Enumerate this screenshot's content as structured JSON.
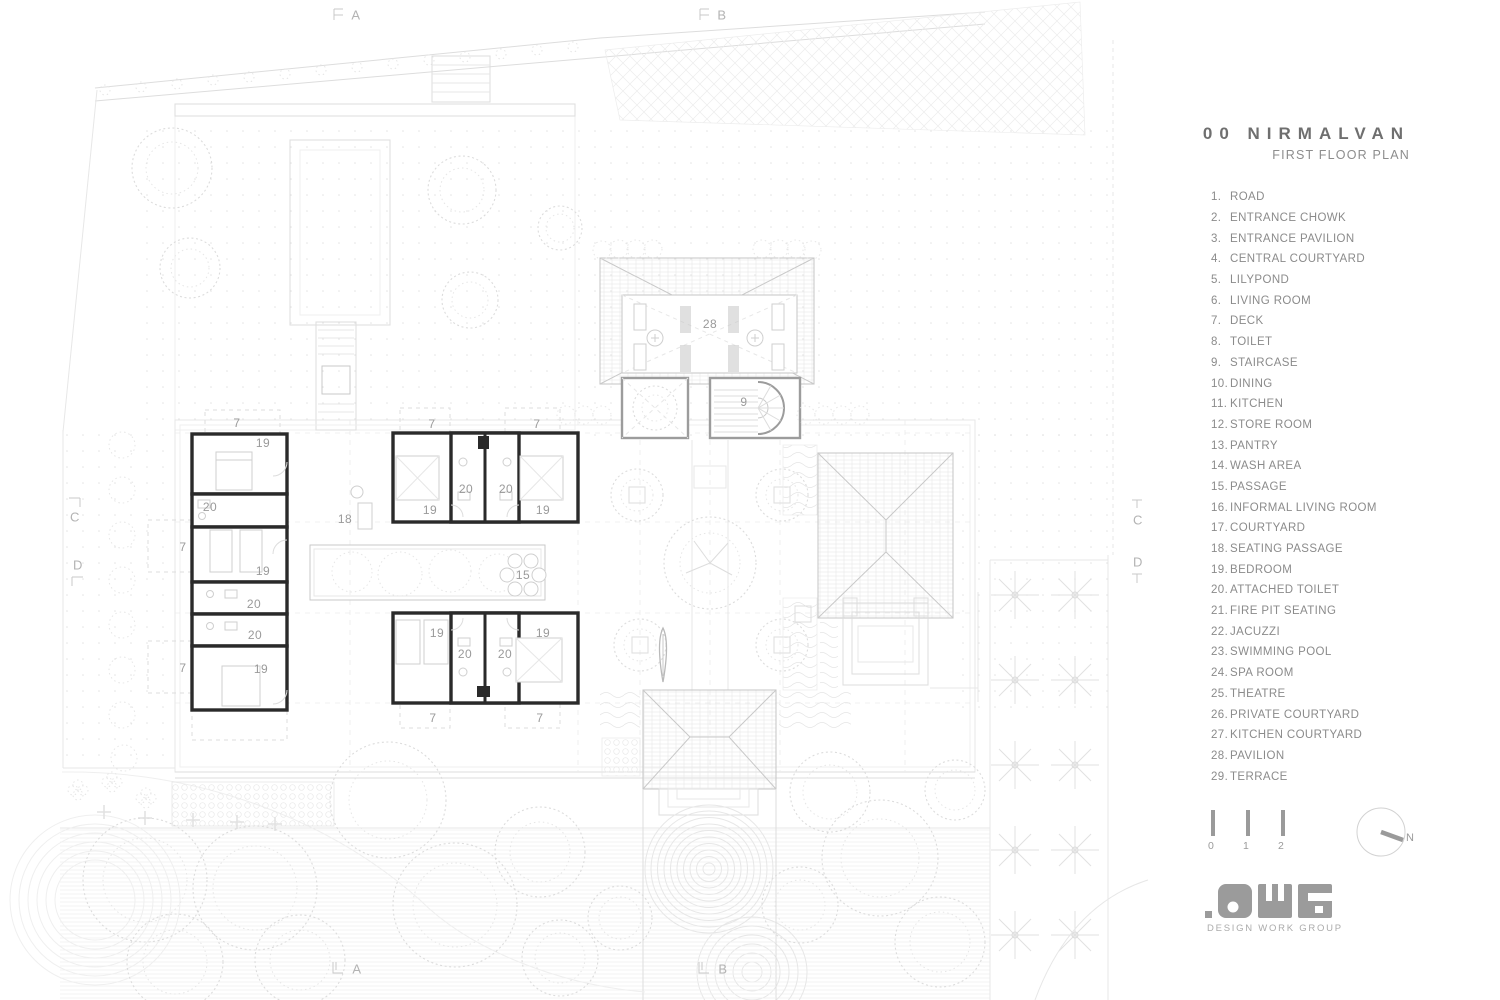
{
  "panel": {
    "title": "00 NIRMALVAN",
    "subtitle": "FIRST FLOOR PLAN",
    "north_label": "N",
    "logo_alt": ".DWG",
    "logo_caption": "DESIGN WORK GROUP"
  },
  "legend": {
    "items": [
      {
        "n": "1.",
        "t": "ROAD"
      },
      {
        "n": "2.",
        "t": "ENTRANCE CHOWK"
      },
      {
        "n": "3.",
        "t": "ENTRANCE PAVILION"
      },
      {
        "n": "4.",
        "t": "CENTRAL COURTYARD"
      },
      {
        "n": "5.",
        "t": "LILYPOND"
      },
      {
        "n": "6.",
        "t": "LIVING ROOM"
      },
      {
        "n": "7.",
        "t": "DECK"
      },
      {
        "n": "8.",
        "t": "TOILET"
      },
      {
        "n": "9.",
        "t": "STAIRCASE"
      },
      {
        "n": "10.",
        "t": "DINING"
      },
      {
        "n": "11.",
        "t": "KITCHEN"
      },
      {
        "n": "12.",
        "t": "STORE ROOM"
      },
      {
        "n": "13.",
        "t": "PANTRY"
      },
      {
        "n": "14.",
        "t": "WASH AREA"
      },
      {
        "n": "15.",
        "t": "PASSAGE"
      },
      {
        "n": "16.",
        "t": "INFORMAL LIVING ROOM"
      },
      {
        "n": "17.",
        "t": "COURTYARD"
      },
      {
        "n": "18.",
        "t": "SEATING PASSAGE"
      },
      {
        "n": "19.",
        "t": "BEDROOM"
      },
      {
        "n": "20.",
        "t": "ATTACHED TOILET"
      },
      {
        "n": "21.",
        "t": "FIRE PIT SEATING"
      },
      {
        "n": "22.",
        "t": "JACUZZI"
      },
      {
        "n": "23.",
        "t": "SWIMMING POOL"
      },
      {
        "n": "24.",
        "t": "SPA ROOM"
      },
      {
        "n": "25.",
        "t": "THEATRE"
      },
      {
        "n": "26.",
        "t": "PRIVATE COURTYARD"
      },
      {
        "n": "27.",
        "t": "KITCHEN COURTYARD"
      },
      {
        "n": "28.",
        "t": "PAVILION"
      },
      {
        "n": "29.",
        "t": "TERRACE"
      }
    ]
  },
  "scale": {
    "labels": [
      "0",
      "1",
      "2"
    ]
  },
  "plan": {
    "room_labels": [
      {
        "t": "28",
        "x": 710,
        "y": 324
      },
      {
        "t": "9",
        "x": 744,
        "y": 402
      },
      {
        "t": "18",
        "x": 345,
        "y": 519
      },
      {
        "t": "15",
        "x": 523,
        "y": 575
      },
      {
        "t": "7",
        "x": 237,
        "y": 423
      },
      {
        "t": "19",
        "x": 263,
        "y": 443
      },
      {
        "t": "20",
        "x": 210,
        "y": 507
      },
      {
        "t": "7",
        "x": 183,
        "y": 547
      },
      {
        "t": "19",
        "x": 263,
        "y": 571
      },
      {
        "t": "20",
        "x": 254,
        "y": 604
      },
      {
        "t": "20",
        "x": 255,
        "y": 635
      },
      {
        "t": "7",
        "x": 183,
        "y": 668
      },
      {
        "t": "19",
        "x": 261,
        "y": 669
      },
      {
        "t": "7",
        "x": 432,
        "y": 424
      },
      {
        "t": "7",
        "x": 537,
        "y": 424
      },
      {
        "t": "20",
        "x": 466,
        "y": 489
      },
      {
        "t": "20",
        "x": 506,
        "y": 489
      },
      {
        "t": "19",
        "x": 430,
        "y": 510
      },
      {
        "t": "19",
        "x": 543,
        "y": 510
      },
      {
        "t": "19",
        "x": 437,
        "y": 633
      },
      {
        "t": "19",
        "x": 543,
        "y": 633
      },
      {
        "t": "20",
        "x": 465,
        "y": 654
      },
      {
        "t": "20",
        "x": 505,
        "y": 654
      },
      {
        "t": "7",
        "x": 433,
        "y": 718
      },
      {
        "t": "7",
        "x": 540,
        "y": 718
      }
    ],
    "section_markers": [
      {
        "t": "A",
        "x": 356,
        "y": 15
      },
      {
        "t": "B",
        "x": 722,
        "y": 15
      },
      {
        "t": "A",
        "x": 357,
        "y": 969
      },
      {
        "t": "B",
        "x": 723,
        "y": 969
      },
      {
        "t": "C",
        "x": 75,
        "y": 517
      },
      {
        "t": "D",
        "x": 78,
        "y": 565
      },
      {
        "t": "C",
        "x": 1138,
        "y": 520
      },
      {
        "t": "D",
        "x": 1138,
        "y": 562
      }
    ]
  },
  "colors": {
    "wall": "#2a2a2a",
    "light_line": "#dedede",
    "label_gray": "#9a9a9a",
    "panel_text": "#8b8b8b",
    "title_gray": "#6f6f6f"
  }
}
